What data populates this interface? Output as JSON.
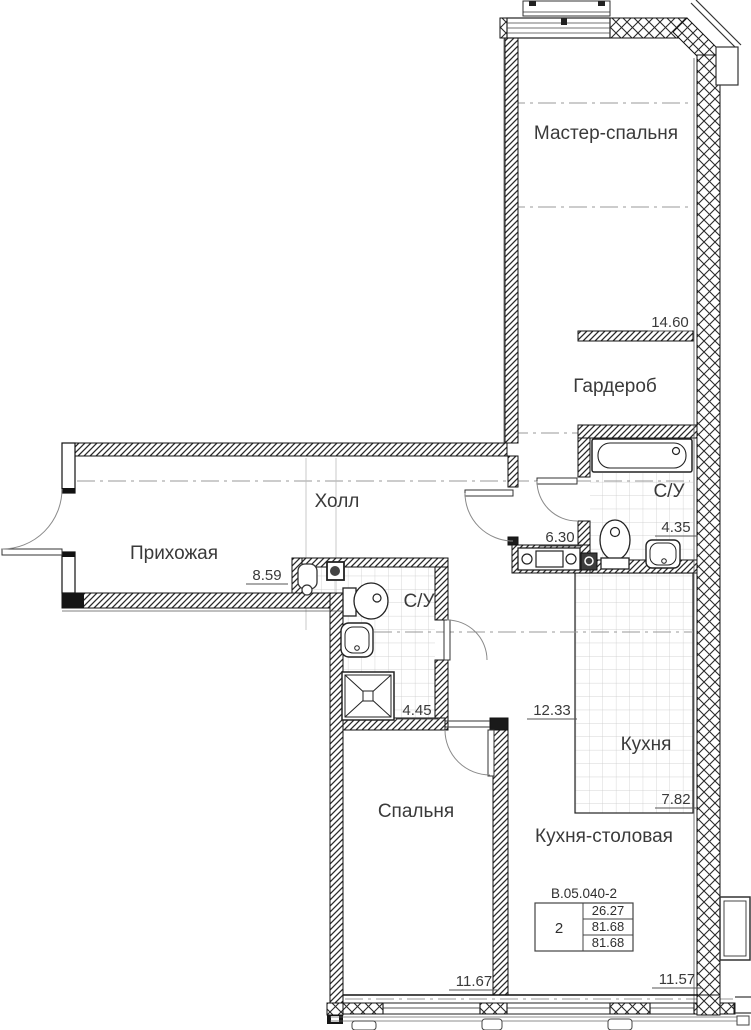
{
  "plan": {
    "rooms": [
      {
        "id": "master-bedroom",
        "label": "Мастер-спальня",
        "area": "14.60"
      },
      {
        "id": "wardrobe",
        "label": "Гардероб",
        "area": ""
      },
      {
        "id": "bathroom-top",
        "label": "С/У",
        "area": "4.35"
      },
      {
        "id": "corridor",
        "label": "",
        "area": "6.30"
      },
      {
        "id": "hall",
        "label": "Холл",
        "area": ""
      },
      {
        "id": "entry",
        "label": "Прихожая",
        "area": "8.59"
      },
      {
        "id": "bathroom-mid",
        "label": "С/У",
        "area": "4.45"
      },
      {
        "id": "dining-zone",
        "label": "",
        "area": "12.33"
      },
      {
        "id": "kitchen",
        "label": "Кухня",
        "area": "7.82"
      },
      {
        "id": "kitchen-dining",
        "label": "Кухня-столовая",
        "area": "11.57"
      },
      {
        "id": "bedroom",
        "label": "Спальня",
        "area": "11.67"
      }
    ],
    "info_table": {
      "title": "В.05.040-2",
      "rooms_count": "2",
      "values": [
        "26.27",
        "81.68",
        "81.68"
      ]
    }
  }
}
